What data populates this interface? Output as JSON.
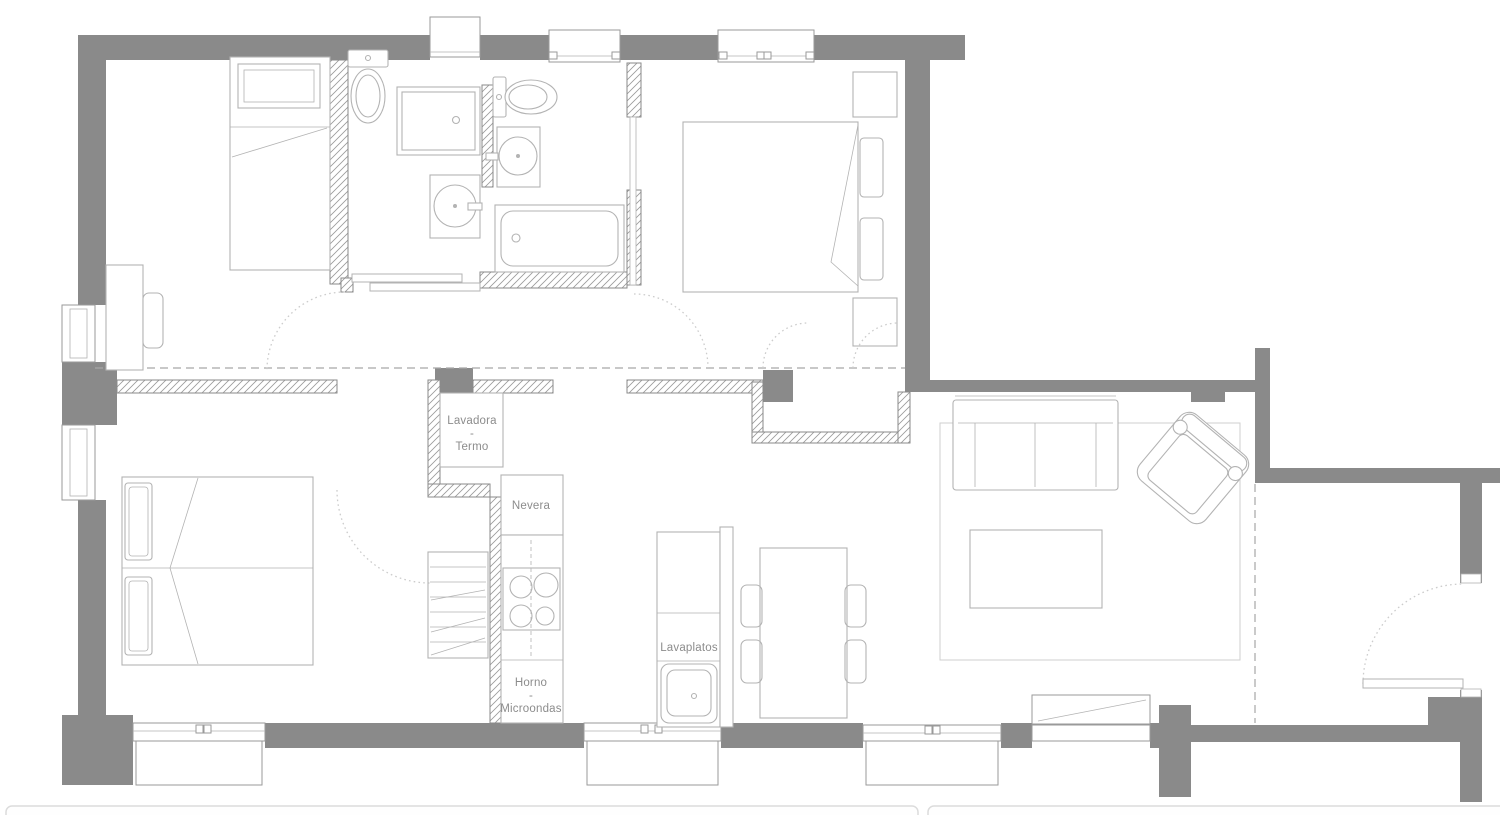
{
  "plan": {
    "colors": {
      "wall": "#8a8a8a",
      "furniture": "#b3b3b3",
      "hatch": "#9a9a9a",
      "window": "#9a9a9a",
      "label": "#8c8c8c",
      "dash": "#a6a6a6",
      "arc": "#cccccc"
    },
    "labels": {
      "washer_heater": [
        "Lavadora",
        "-",
        "Termo"
      ],
      "fridge": "Nevera",
      "oven_microwave": [
        "Horno",
        "-",
        "Microondas"
      ],
      "dishwasher": "Lavaplatos"
    }
  }
}
